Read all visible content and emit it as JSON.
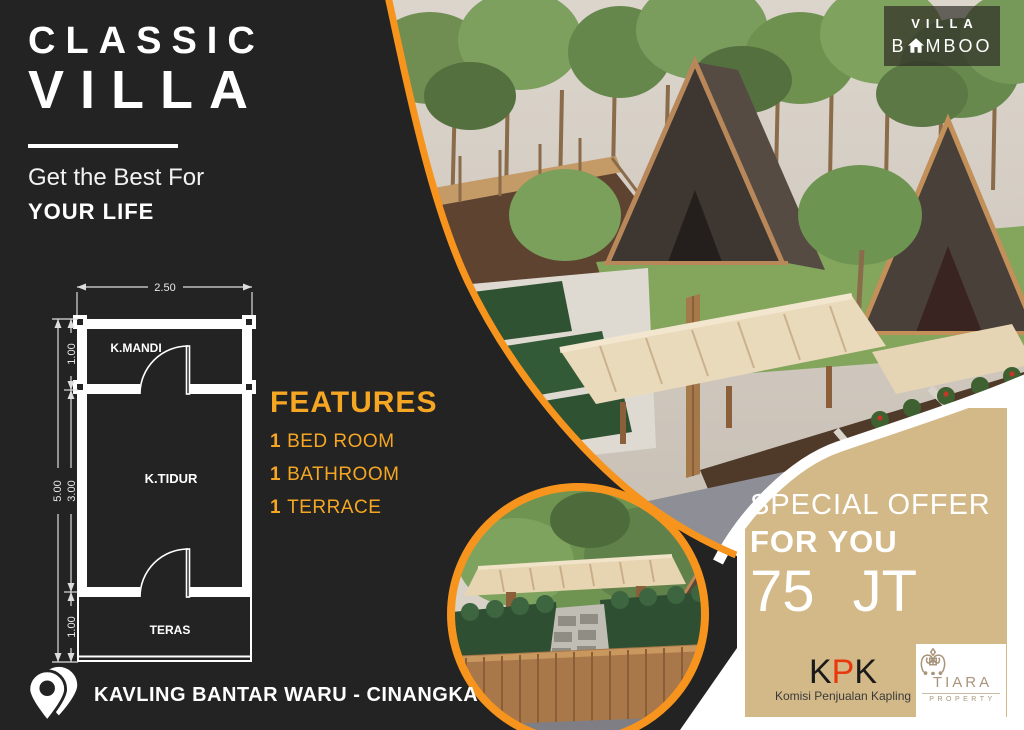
{
  "left_panel": {
    "title_line1": "CLASSIC",
    "title_line2": "VILLA",
    "tagline_line1": "Get the Best For",
    "tagline_line2": "YOUR LIFE",
    "features": {
      "heading": "FEATURES",
      "items": [
        {
          "qty": "1",
          "label": "BED ROOM"
        },
        {
          "qty": "1",
          "label": "BATHROOM"
        },
        {
          "qty": "1",
          "label": "TERRACE"
        }
      ]
    },
    "location": "KAVLING BANTAR WARU - CINANGKA"
  },
  "floor_plan": {
    "rooms": [
      "K.MANDI",
      "K.TIDUR",
      "TERAS"
    ],
    "dims": {
      "width": "2.50",
      "total_height": "5.00",
      "bathroom": "1.00",
      "bedroom": "3.00",
      "terrace": "1.00"
    }
  },
  "brand": {
    "line1": "VILLA",
    "line2_prefix": "B",
    "line2_suffix": "MBOO"
  },
  "offer": {
    "line1": "SPECIAL OFFER",
    "line2": "FOR YOU",
    "line3": "75 JT"
  },
  "logos": {
    "kpk": {
      "k1": "K",
      "p": "P",
      "k2": "K",
      "subtitle": "Komisi Penjualan Kapling"
    },
    "tiara": {
      "name": "TIARA",
      "subtitle": "PROPERTY"
    }
  },
  "colors": {
    "panel_dark": "#232323",
    "accent_orange": "#F5A623",
    "curve_orange": "#F7941E",
    "panel_tan": "#D3B988",
    "kpk_red": "#E8380D",
    "tiara_tan": "#A8947A"
  }
}
